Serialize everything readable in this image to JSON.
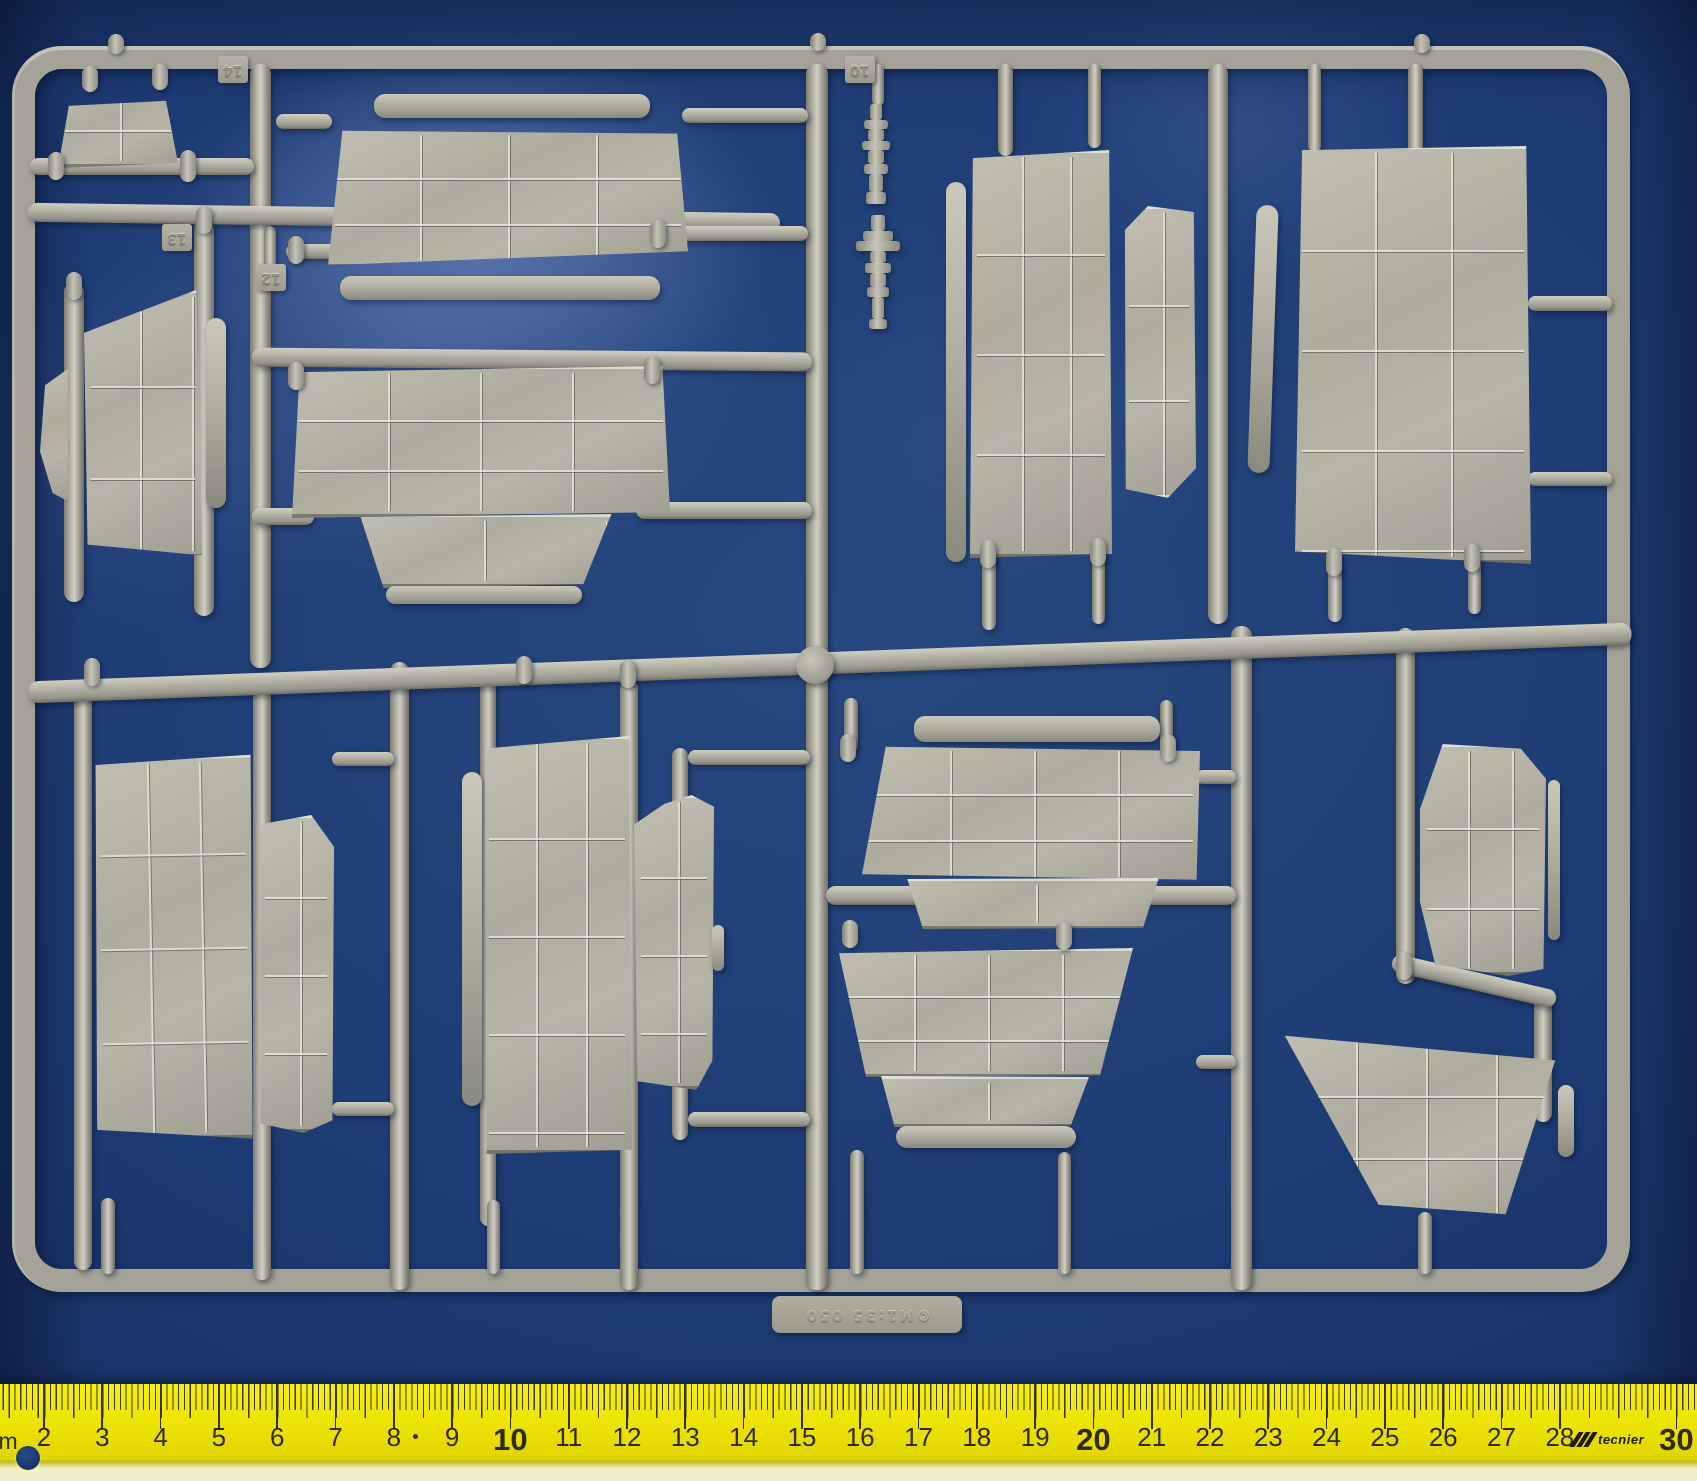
{
  "scene": {
    "alt": "grey plastic model kit sprue of panel parts on a blue background, yellow centimetre ruler along the bottom"
  },
  "colors": {
    "background_blue": "#1c3a72",
    "plastic_grey": "#a8a69a",
    "panel_grey": "#b0afa2",
    "ruler_yellow": "#ece205",
    "tick_color": "#3a3712"
  },
  "sprue": {
    "part_tags": [
      {
        "label": "14"
      },
      {
        "label": "13"
      },
      {
        "label": "12"
      },
      {
        "label": "10"
      }
    ],
    "molded_label": "©M1:35 050"
  },
  "ruler": {
    "unit_label": "cm",
    "brand": "tecnier",
    "marks": [
      {
        "label": "2",
        "cm": 2
      },
      {
        "label": "3",
        "cm": 3
      },
      {
        "label": "4",
        "cm": 4
      },
      {
        "label": "5",
        "cm": 5
      },
      {
        "label": "6",
        "cm": 6
      },
      {
        "label": "7",
        "cm": 7
      },
      {
        "label": "8",
        "cm": 8
      },
      {
        "label": "9",
        "cm": 9
      },
      {
        "label": "10",
        "cm": 10
      },
      {
        "label": "11",
        "cm": 11
      },
      {
        "label": "12",
        "cm": 12
      },
      {
        "label": "13",
        "cm": 13
      },
      {
        "label": "14",
        "cm": 14
      },
      {
        "label": "15",
        "cm": 15
      },
      {
        "label": "16",
        "cm": 16
      },
      {
        "label": "17",
        "cm": 17
      },
      {
        "label": "18",
        "cm": 18
      },
      {
        "label": "19",
        "cm": 19
      },
      {
        "label": "20",
        "cm": 20
      },
      {
        "label": "21",
        "cm": 21
      },
      {
        "label": "22",
        "cm": 22
      },
      {
        "label": "23",
        "cm": 23
      },
      {
        "label": "24",
        "cm": 24
      },
      {
        "label": "25",
        "cm": 25
      },
      {
        "label": "26",
        "cm": 26
      },
      {
        "label": "27",
        "cm": 27
      },
      {
        "label": "28",
        "cm": 28
      },
      {
        "label": "30",
        "cm": 30
      }
    ]
  }
}
